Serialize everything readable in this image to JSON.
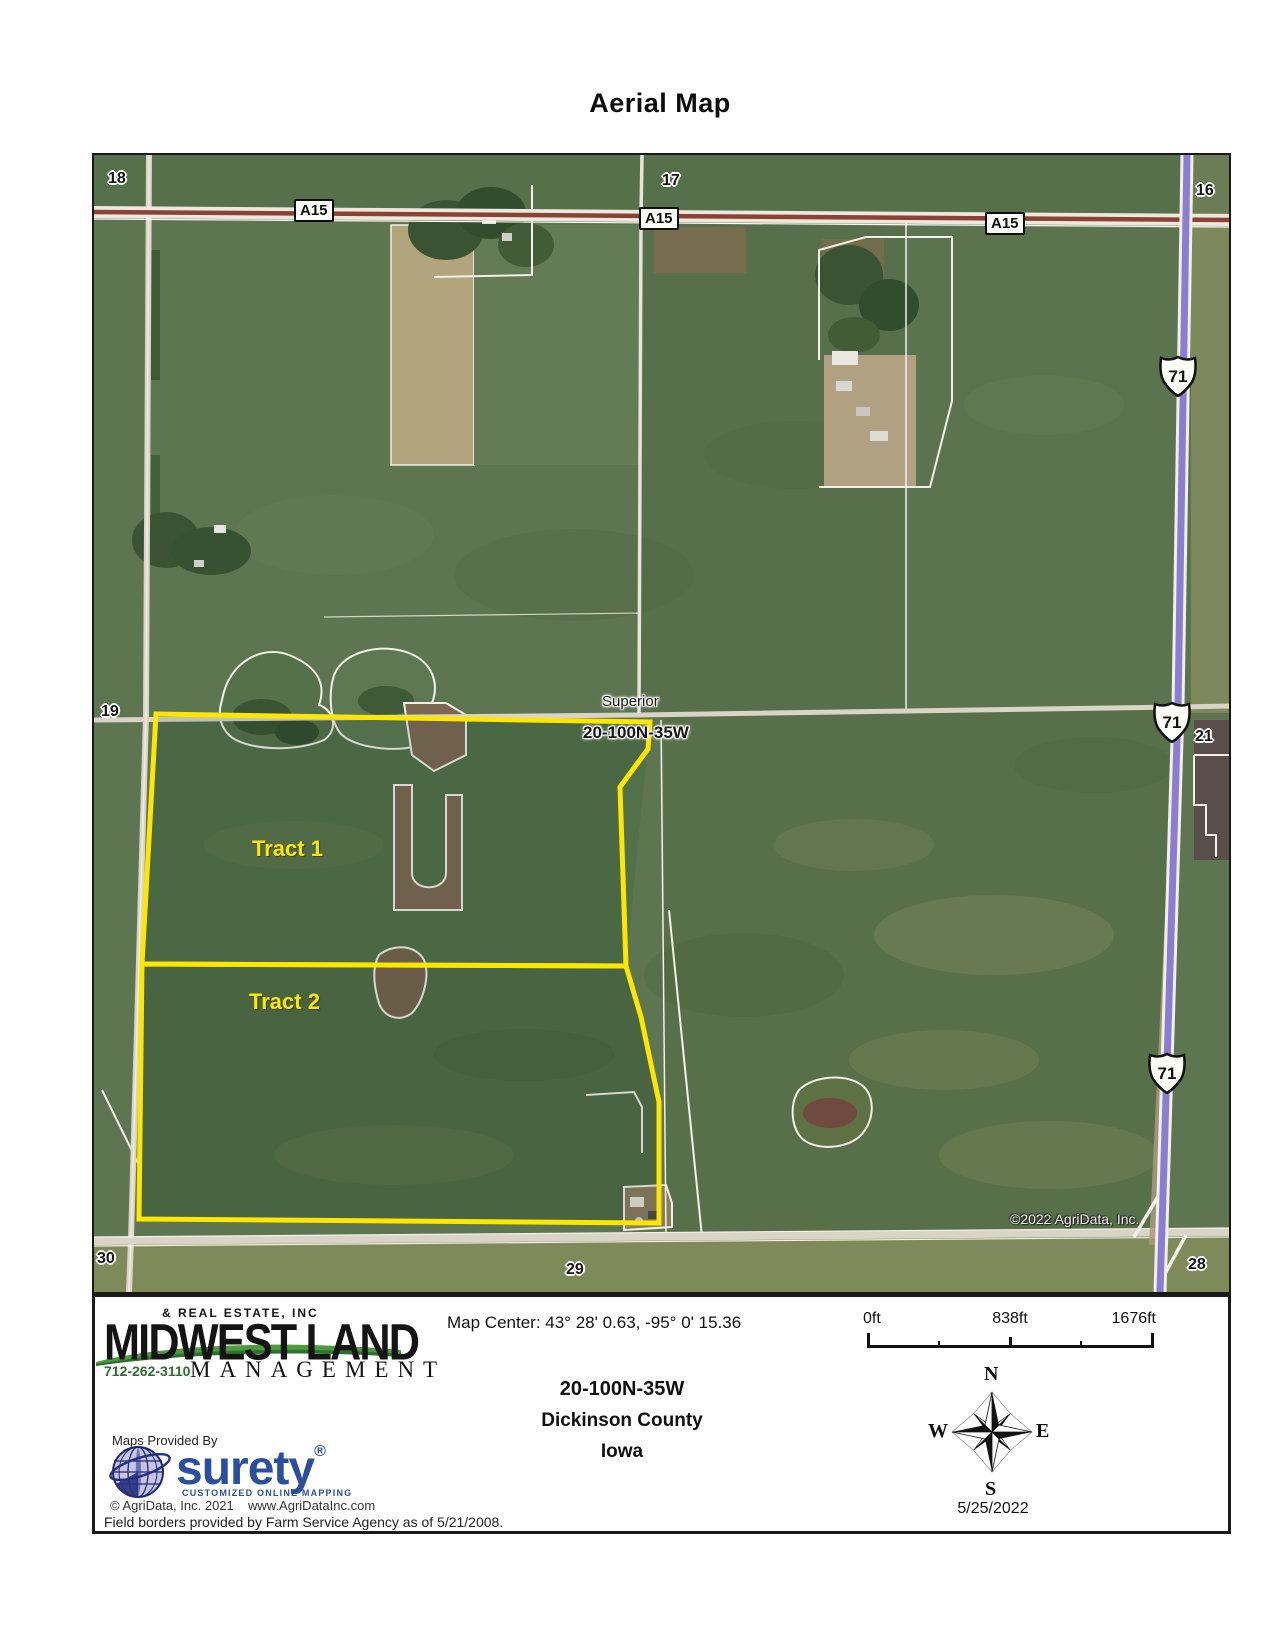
{
  "page": {
    "title": "Aerial Map"
  },
  "map": {
    "copyright": "©2022 AgriData, Inc.",
    "place": "Superior",
    "township": "20-100N-35W",
    "sections": {
      "nw": "18",
      "n": "17",
      "ne": "16",
      "w": "19",
      "e": "21",
      "sw": "30",
      "s": "29",
      "se": "28"
    },
    "road_label": "A15",
    "highway_label": "71",
    "tract1_label": "Tract 1",
    "tract2_label": "Tract 2",
    "colors": {
      "tract_outline": "#ffe600",
      "highway": "#8b7dd2",
      "road_stripe": "#8a4136"
    }
  },
  "footer": {
    "brand": {
      "tagline_top": "& REAL ESTATE, INC",
      "name": "MIDWEST LAND",
      "name_sub": "MANAGEMENT",
      "phone": "712-262-3110"
    },
    "map_center": "Map Center: 43° 28' 0.63,  -95° 0' 15.36",
    "township": "20-100N-35W",
    "county": "Dickinson County",
    "state": "Iowa",
    "scale": {
      "zero": "0ft",
      "mid": "838ft",
      "max": "1676ft"
    },
    "compass": {
      "n": "N",
      "e": "E",
      "s": "S",
      "w": "W"
    },
    "date": "5/25/2022",
    "provider": {
      "label": "Maps Provided By",
      "name": "surety",
      "registered": "®",
      "tagline": "CUSTOMIZED ONLINE MAPPING",
      "copyright": "© AgriData, Inc. 2021",
      "website": "www.AgriDataInc.com"
    },
    "disclaimer": "Field borders provided by Farm Service Agency as of 5/21/2008."
  }
}
